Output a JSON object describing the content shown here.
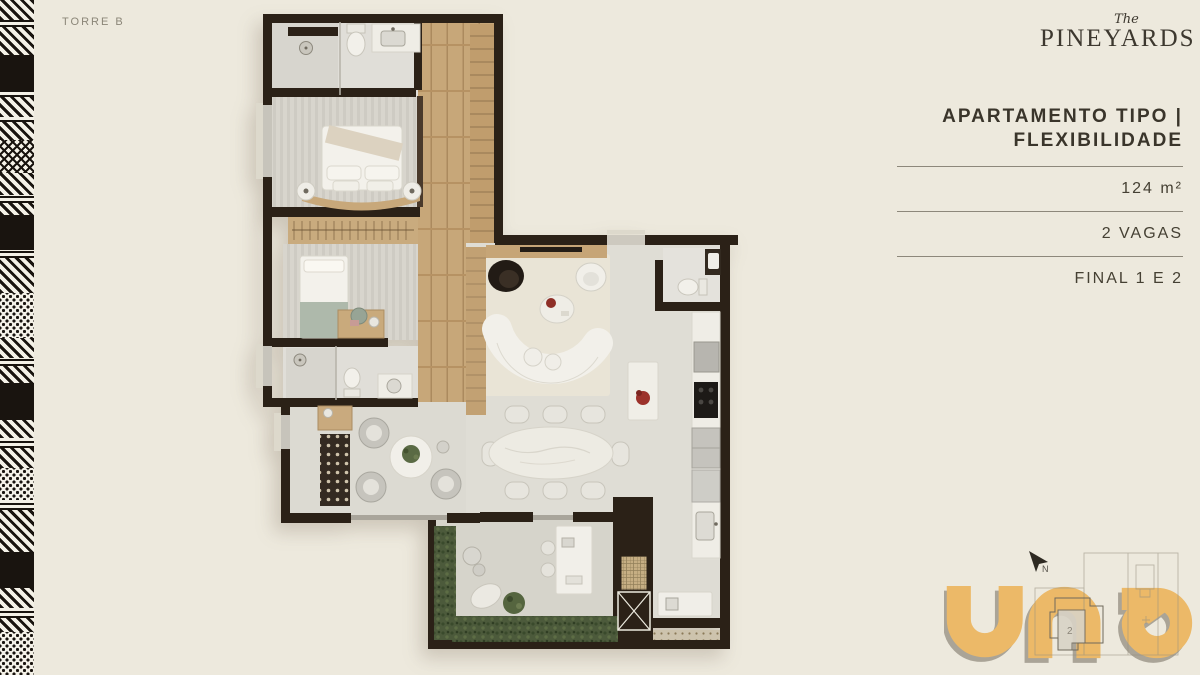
{
  "slide": {
    "background": "#EDE9DD"
  },
  "tower": {
    "label": "TORRE B"
  },
  "brand": {
    "pre": "The",
    "name": "PINEYARDS"
  },
  "panel": {
    "title_line1": "APARTAMENTO TIPO |",
    "title_line2": "FLEXIBILIDADE",
    "specs": [
      "124 m²",
      "2 VAGAS",
      "FINAL 1 E 2"
    ]
  },
  "plan": {
    "compass_label": "N",
    "keyplan_unit": "2"
  },
  "logo": {
    "name": "una",
    "color": "#ECB968"
  },
  "colors": {
    "background": "#EDE9DD",
    "wall": "#2B2117",
    "wood": "#C7A779",
    "carpet": "#D8D5CD",
    "living_floor": "#DFDDD5",
    "hedge_green": "#4C5A3B",
    "accent_gold": "#ECB968",
    "text_dark": "#3A352B",
    "rule_line": "#8D887B"
  }
}
